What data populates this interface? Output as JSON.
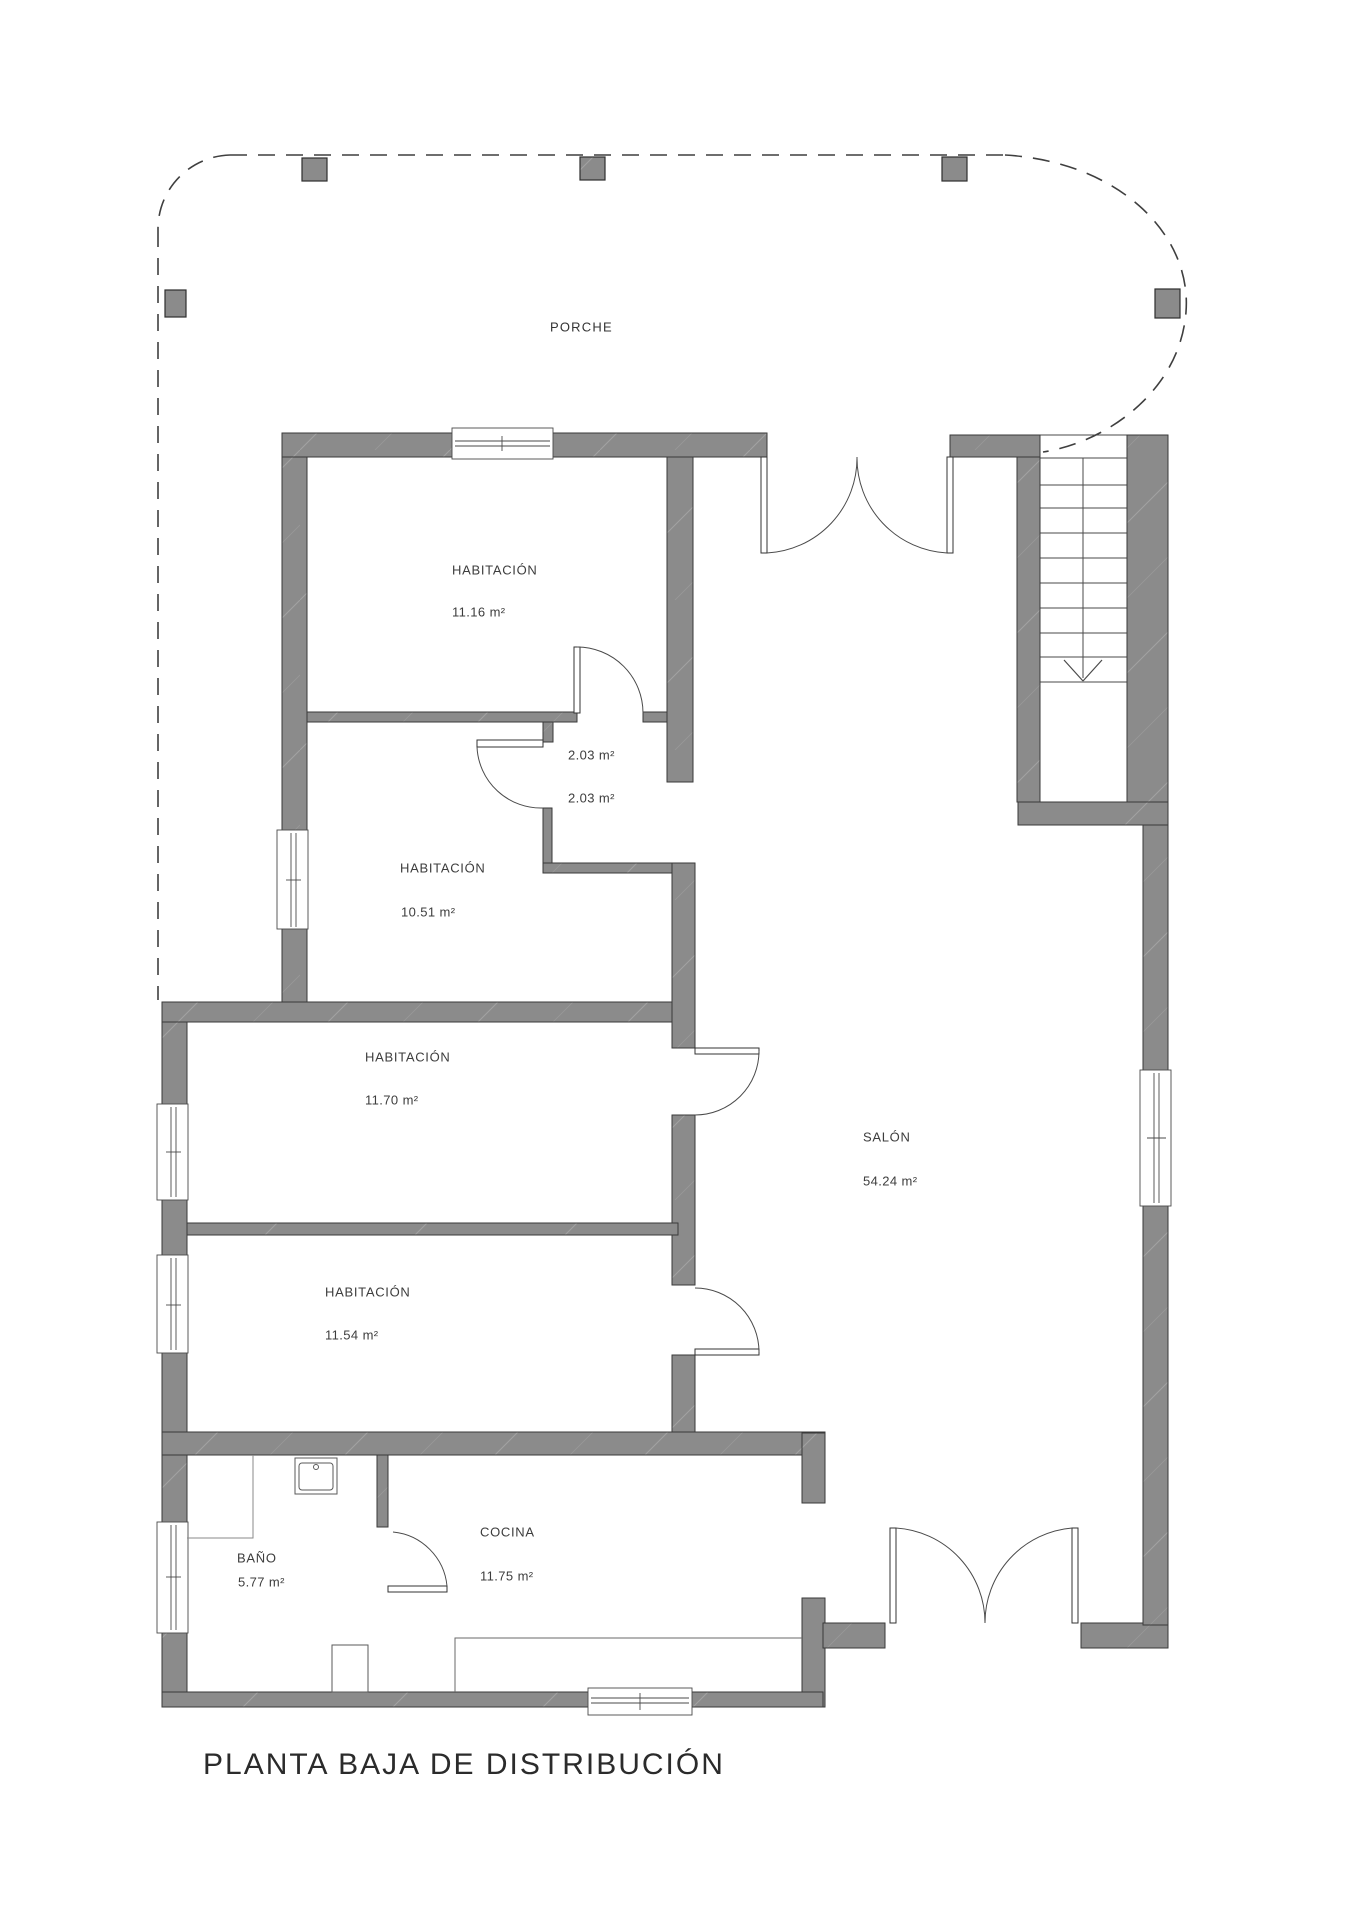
{
  "title": "PLANTA BAJA DE DISTRIBUCIÓN",
  "plan": {
    "porch": {
      "label": "PORCHE"
    },
    "rooms": [
      {
        "id": "habitacion-1116",
        "label": "HABITACIÓN",
        "area": "11.16 m²"
      },
      {
        "id": "closet-a",
        "area": "2.03 m²"
      },
      {
        "id": "closet-b",
        "area": "2.03 m²"
      },
      {
        "id": "habitacion-1051",
        "label": "HABITACIÓN",
        "area": "10.51 m²"
      },
      {
        "id": "habitacion-1170",
        "label": "HABITACIÓN",
        "area": "11.70 m²"
      },
      {
        "id": "habitacion-1154",
        "label": "HABITACIÓN",
        "area": "11.54 m²"
      },
      {
        "id": "salon",
        "label": "SALÓN",
        "area": "54.24 m²"
      },
      {
        "id": "bano",
        "label": "BAÑO",
        "area": "5.77 m²"
      },
      {
        "id": "cocina",
        "label": "COCINA",
        "area": "11.75 m²"
      }
    ],
    "stairs": {
      "direction": "down"
    }
  },
  "colors": {
    "wall": "#8b8b8b",
    "wall_outline": "#3a3a3a",
    "line": "#4a4a4a",
    "text": "#3d3d3d",
    "background": "#ffffff"
  }
}
